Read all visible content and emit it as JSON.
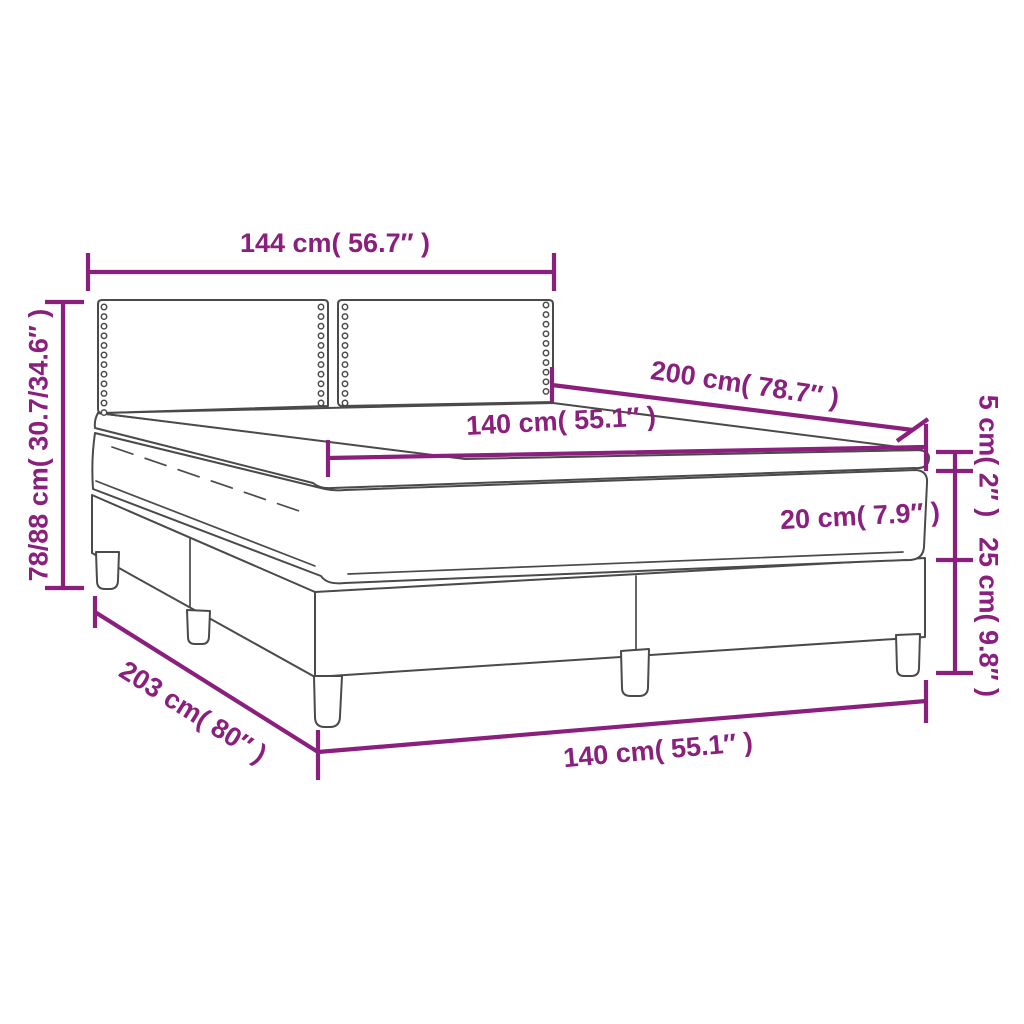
{
  "diagram": {
    "type": "furniture-dimension-drawing",
    "subject": "box spring bed with headboard, mattress and mattress topper",
    "colors": {
      "dimension_accent": "#8A1F7D",
      "drawing_outline": "#4A4A4A",
      "background": "#FFFFFF"
    },
    "labels": {
      "headboard_width": "144 cm( 56.7″ )",
      "total_height": "78/88 cm( 30.7/34.6″ )",
      "bed_length": "200 cm( 78.7″ )",
      "mattress_width": "140 cm( 55.1″ )",
      "topper_thickness": "5 cm( 2″ )",
      "mattress_thickness": "20 cm( 7.9″ )",
      "base_height": "25 cm( 9.8″ )",
      "base_length": "203 cm( 80″ )",
      "base_width": "140 cm( 55.1″ )"
    }
  }
}
